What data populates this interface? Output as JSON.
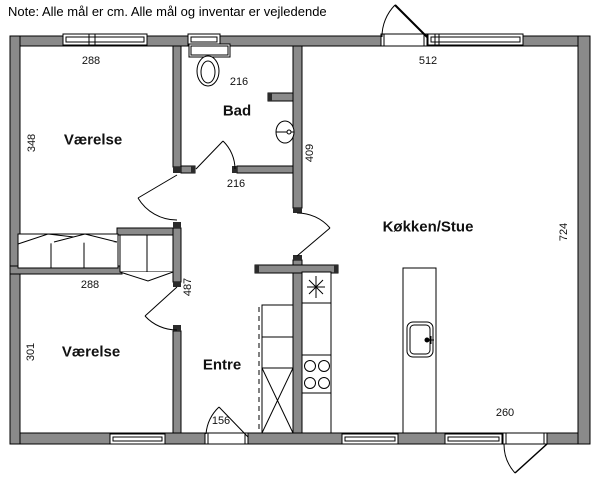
{
  "note": "Note: Alle mål er cm. Alle mål og inventar er vejledende",
  "rooms": {
    "bedroom_top": "Værelse",
    "bathroom": "Bad",
    "kitchen_living": "Køkken/Stue",
    "bedroom_bottom": "Værelse",
    "hall": "Entre"
  },
  "dimensions": {
    "bedroom_top_width": "288",
    "bedroom_top_height": "348",
    "bathroom_width_top": "216",
    "bathroom_width_bottom": "216",
    "kitchen_width": "512",
    "bath_hall_depth": "409",
    "kitchen_height": "724",
    "bedroom_bottom_width": "288",
    "hall_length": "487",
    "bedroom_bottom_height": "301",
    "entre_door_width": "156",
    "terrace_door_offset": "260"
  },
  "fixtures": [
    "toilet",
    "washbasin",
    "freezer-star",
    "stove",
    "kitchen-island",
    "kitchen-sink",
    "wardrobe",
    "tall-cabinet"
  ],
  "colors": {
    "wall": "#8a8a8a",
    "line": "#000000",
    "background": "#ffffff"
  }
}
